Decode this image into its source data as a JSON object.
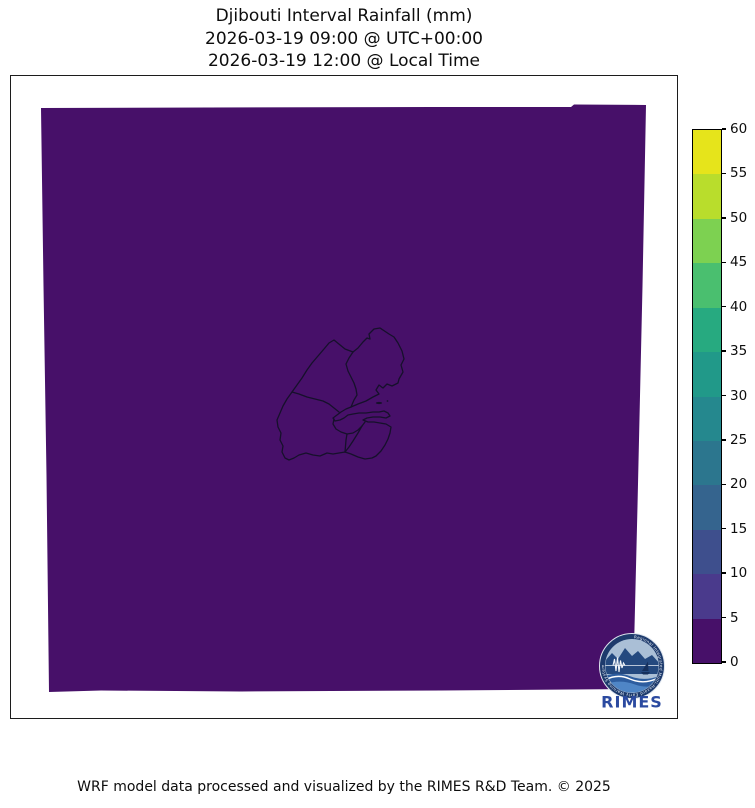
{
  "title": {
    "line1": "Djibouti Interval Rainfall (mm)",
    "line2": "2026-03-19 09:00 @ UTC+00:00",
    "line3": "2026-03-19 12:00 @ Local Time"
  },
  "footer": "WRF model data processed and visualized by the RIMES R&D Team. © 2025",
  "map": {
    "field_color": "#471069",
    "outline_color": "#16102b",
    "background": "#ffffff"
  },
  "colorbar": {
    "ticks": [
      "60",
      "55",
      "50",
      "45",
      "40",
      "35",
      "30",
      "25",
      "20",
      "15",
      "10",
      "5",
      "0"
    ],
    "segment_colors_top_to_bottom": [
      "#e6e41b",
      "#b9dd2c",
      "#7dd151",
      "#4abf6f",
      "#27aa80",
      "#219989",
      "#25888e",
      "#2c768e",
      "#35648e",
      "#3e4f8d",
      "#4a3a8c",
      "#471069"
    ]
  },
  "logo": {
    "text": "RIMES",
    "ring_text": "Regional Integrated Multi-Hazard Early Warning System",
    "text_color": "#2b4aa0",
    "ring_color": "#1d3a6c"
  },
  "chart_data": {
    "type": "heatmap",
    "title": "Djibouti Interval Rainfall (mm)",
    "subtitle_utc": "2026-03-19 09:00 @ UTC+00:00",
    "subtitle_local": "2026-03-19 12:00 @ Local Time",
    "units": "mm",
    "colorbar_boundaries": [
      0,
      5,
      10,
      15,
      20,
      25,
      30,
      35,
      40,
      45,
      50,
      55,
      60
    ],
    "field_description": "uniform rainfall field in lowest bin (0–5 mm) across entire WRF domain",
    "legend_position": "right-colorbar"
  }
}
